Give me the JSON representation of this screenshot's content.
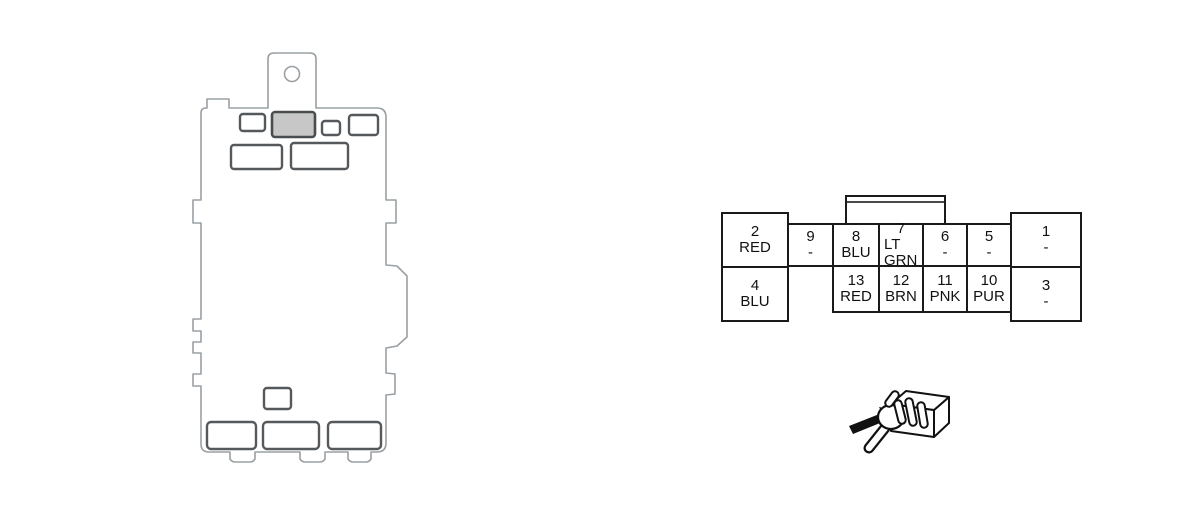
{
  "connector": {
    "left_block": {
      "top": {
        "pin": "2",
        "color": "RED"
      },
      "bottom": {
        "pin": "4",
        "color": "BLU"
      }
    },
    "bridge_cell": {
      "pin": "9",
      "color": "-"
    },
    "middle_top": [
      {
        "pin": "8",
        "color": "BLU"
      },
      {
        "pin": "7",
        "color": "LT GRN"
      },
      {
        "pin": "6",
        "color": "-"
      },
      {
        "pin": "5",
        "color": "-"
      }
    ],
    "middle_bottom": [
      {
        "pin": "13",
        "color": "RED"
      },
      {
        "pin": "12",
        "color": "BRN"
      },
      {
        "pin": "11",
        "color": "PNK"
      },
      {
        "pin": "10",
        "color": "PUR"
      }
    ],
    "right_block": {
      "top": {
        "pin": "1",
        "color": "-"
      },
      "bottom": {
        "pin": "3",
        "color": "-"
      }
    }
  },
  "icons": {
    "fuse_box": "fuse-relay-box-outline",
    "grip": "hand-gripping-connector",
    "arrow": "direction-arrow"
  },
  "colors": {
    "table_line": "#1a1a1a",
    "box_outline": "#9aa0a4",
    "slot_outline": "#56595c",
    "highlight_slot_fill": "#c6c7c6",
    "icon_ink": "#111111",
    "background": "#ffffff"
  }
}
